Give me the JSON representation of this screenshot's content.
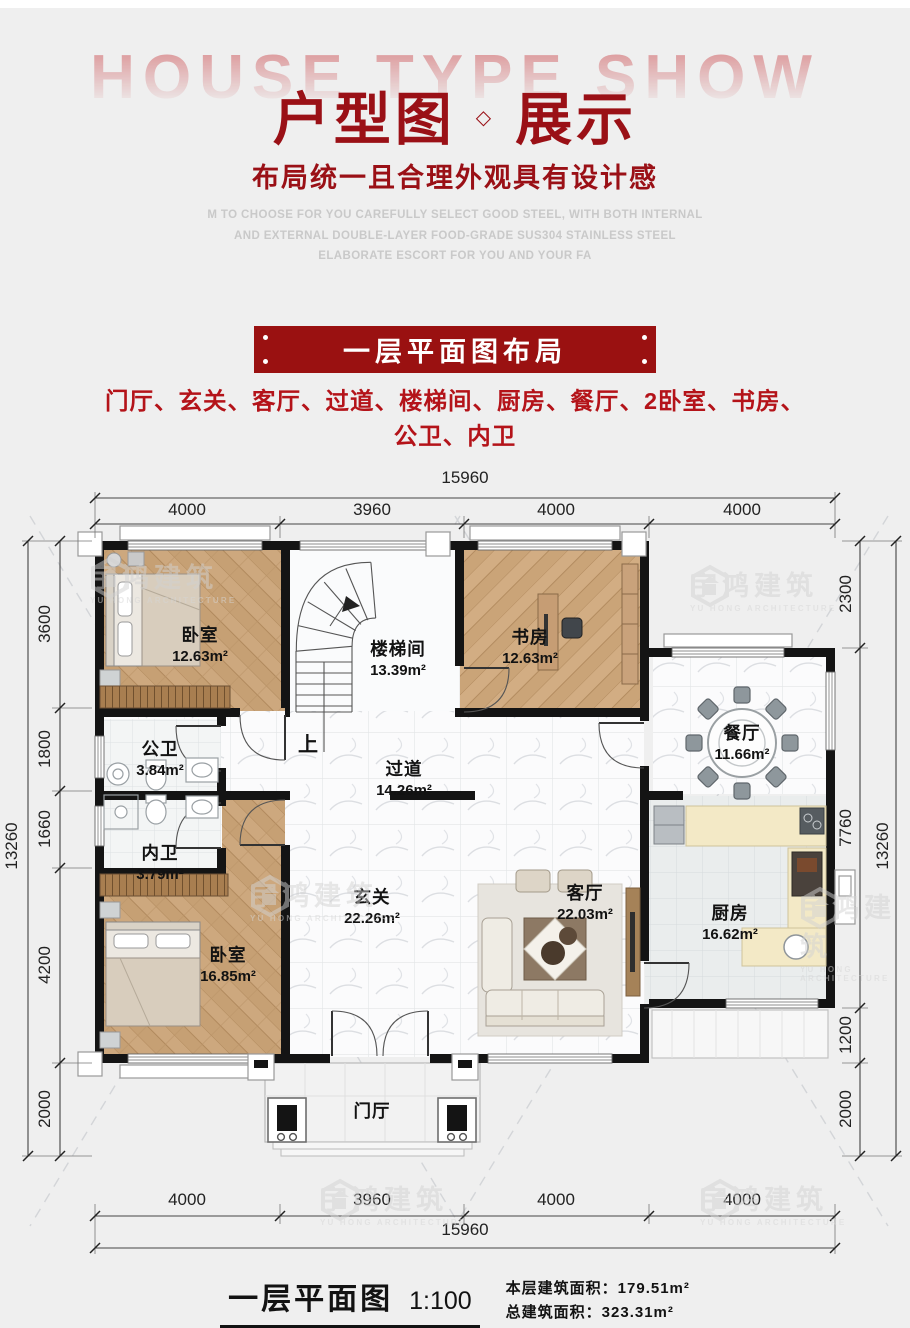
{
  "header": {
    "bg_title": "HOUSE TYPE SHOW",
    "title_left": "户型图",
    "title_diamond": "◇",
    "title_right": "展示",
    "subtitle": "布局统一且合理外观具有设计感",
    "desc_line1": "M TO CHOOSE FOR YOU CAREFULLY SELECT GOOD STEEL, WITH BOTH INTERNAL",
    "desc_line2": "AND EXTERNAL DOUBLE-LAYER FOOD-GRADE SUS304 STAINLESS STEEL",
    "desc_line3": "ELABORATE ESCORT FOR YOU AND YOUR FA"
  },
  "intro": {
    "banner": "一层平面图布局",
    "list_line1": "门厅、玄关、客厅、过道、楼梯间、厨房、餐厅、2卧室、书房、",
    "list_line2": "公卫、内卫"
  },
  "plan": {
    "up_label": "上",
    "rooms": [
      {
        "name": "卧室",
        "area": "12.63m²"
      },
      {
        "name": "楼梯间",
        "area": "13.39m²"
      },
      {
        "name": "书房",
        "area": "12.63m²"
      },
      {
        "name": "餐厅",
        "area": "11.66m²"
      },
      {
        "name": "公卫",
        "area": "3.84m²"
      },
      {
        "name": "过道",
        "area": "14.26m²"
      },
      {
        "name": "内卫",
        "area": "3.79m²"
      },
      {
        "name": "卧室",
        "area": "16.85m²"
      },
      {
        "name": "玄关",
        "area": "22.26m²"
      },
      {
        "name": "客厅",
        "area": "22.03m²"
      },
      {
        "name": "厨房",
        "area": "16.62m²"
      },
      {
        "name": "门厅",
        "area": ""
      }
    ],
    "dims": {
      "top_total": "15960",
      "top_segments": [
        "4000",
        "3960",
        "4000",
        "4000"
      ],
      "bottom_segments": [
        "4000",
        "3960",
        "4000",
        "4000"
      ],
      "bottom_total": "15960",
      "left_total": "13260",
      "left_segments": [
        "3600",
        "1800",
        "1660",
        "4200",
        "2000"
      ],
      "right_segments": [
        "2300",
        "7760",
        "1200",
        "2000"
      ],
      "right_total": "13260"
    }
  },
  "watermark": {
    "cn": "宇鸿建筑",
    "en": "YU HONG ARCHITECTURE"
  },
  "footer": {
    "plan_name": "一层平面图",
    "scale": "1:100",
    "area1_label": "本层建筑面积：",
    "area1_value": "179.51m²",
    "area2_label": "总建筑面积：",
    "area2_value": "323.31m²"
  },
  "colors": {
    "accent_red": "#9a1016",
    "banner_red": "#9a1111",
    "list_red": "#b41319",
    "wall_black": "#141414",
    "wood_floor": "#cda87e",
    "marble_floor": "#fbfbfc"
  }
}
